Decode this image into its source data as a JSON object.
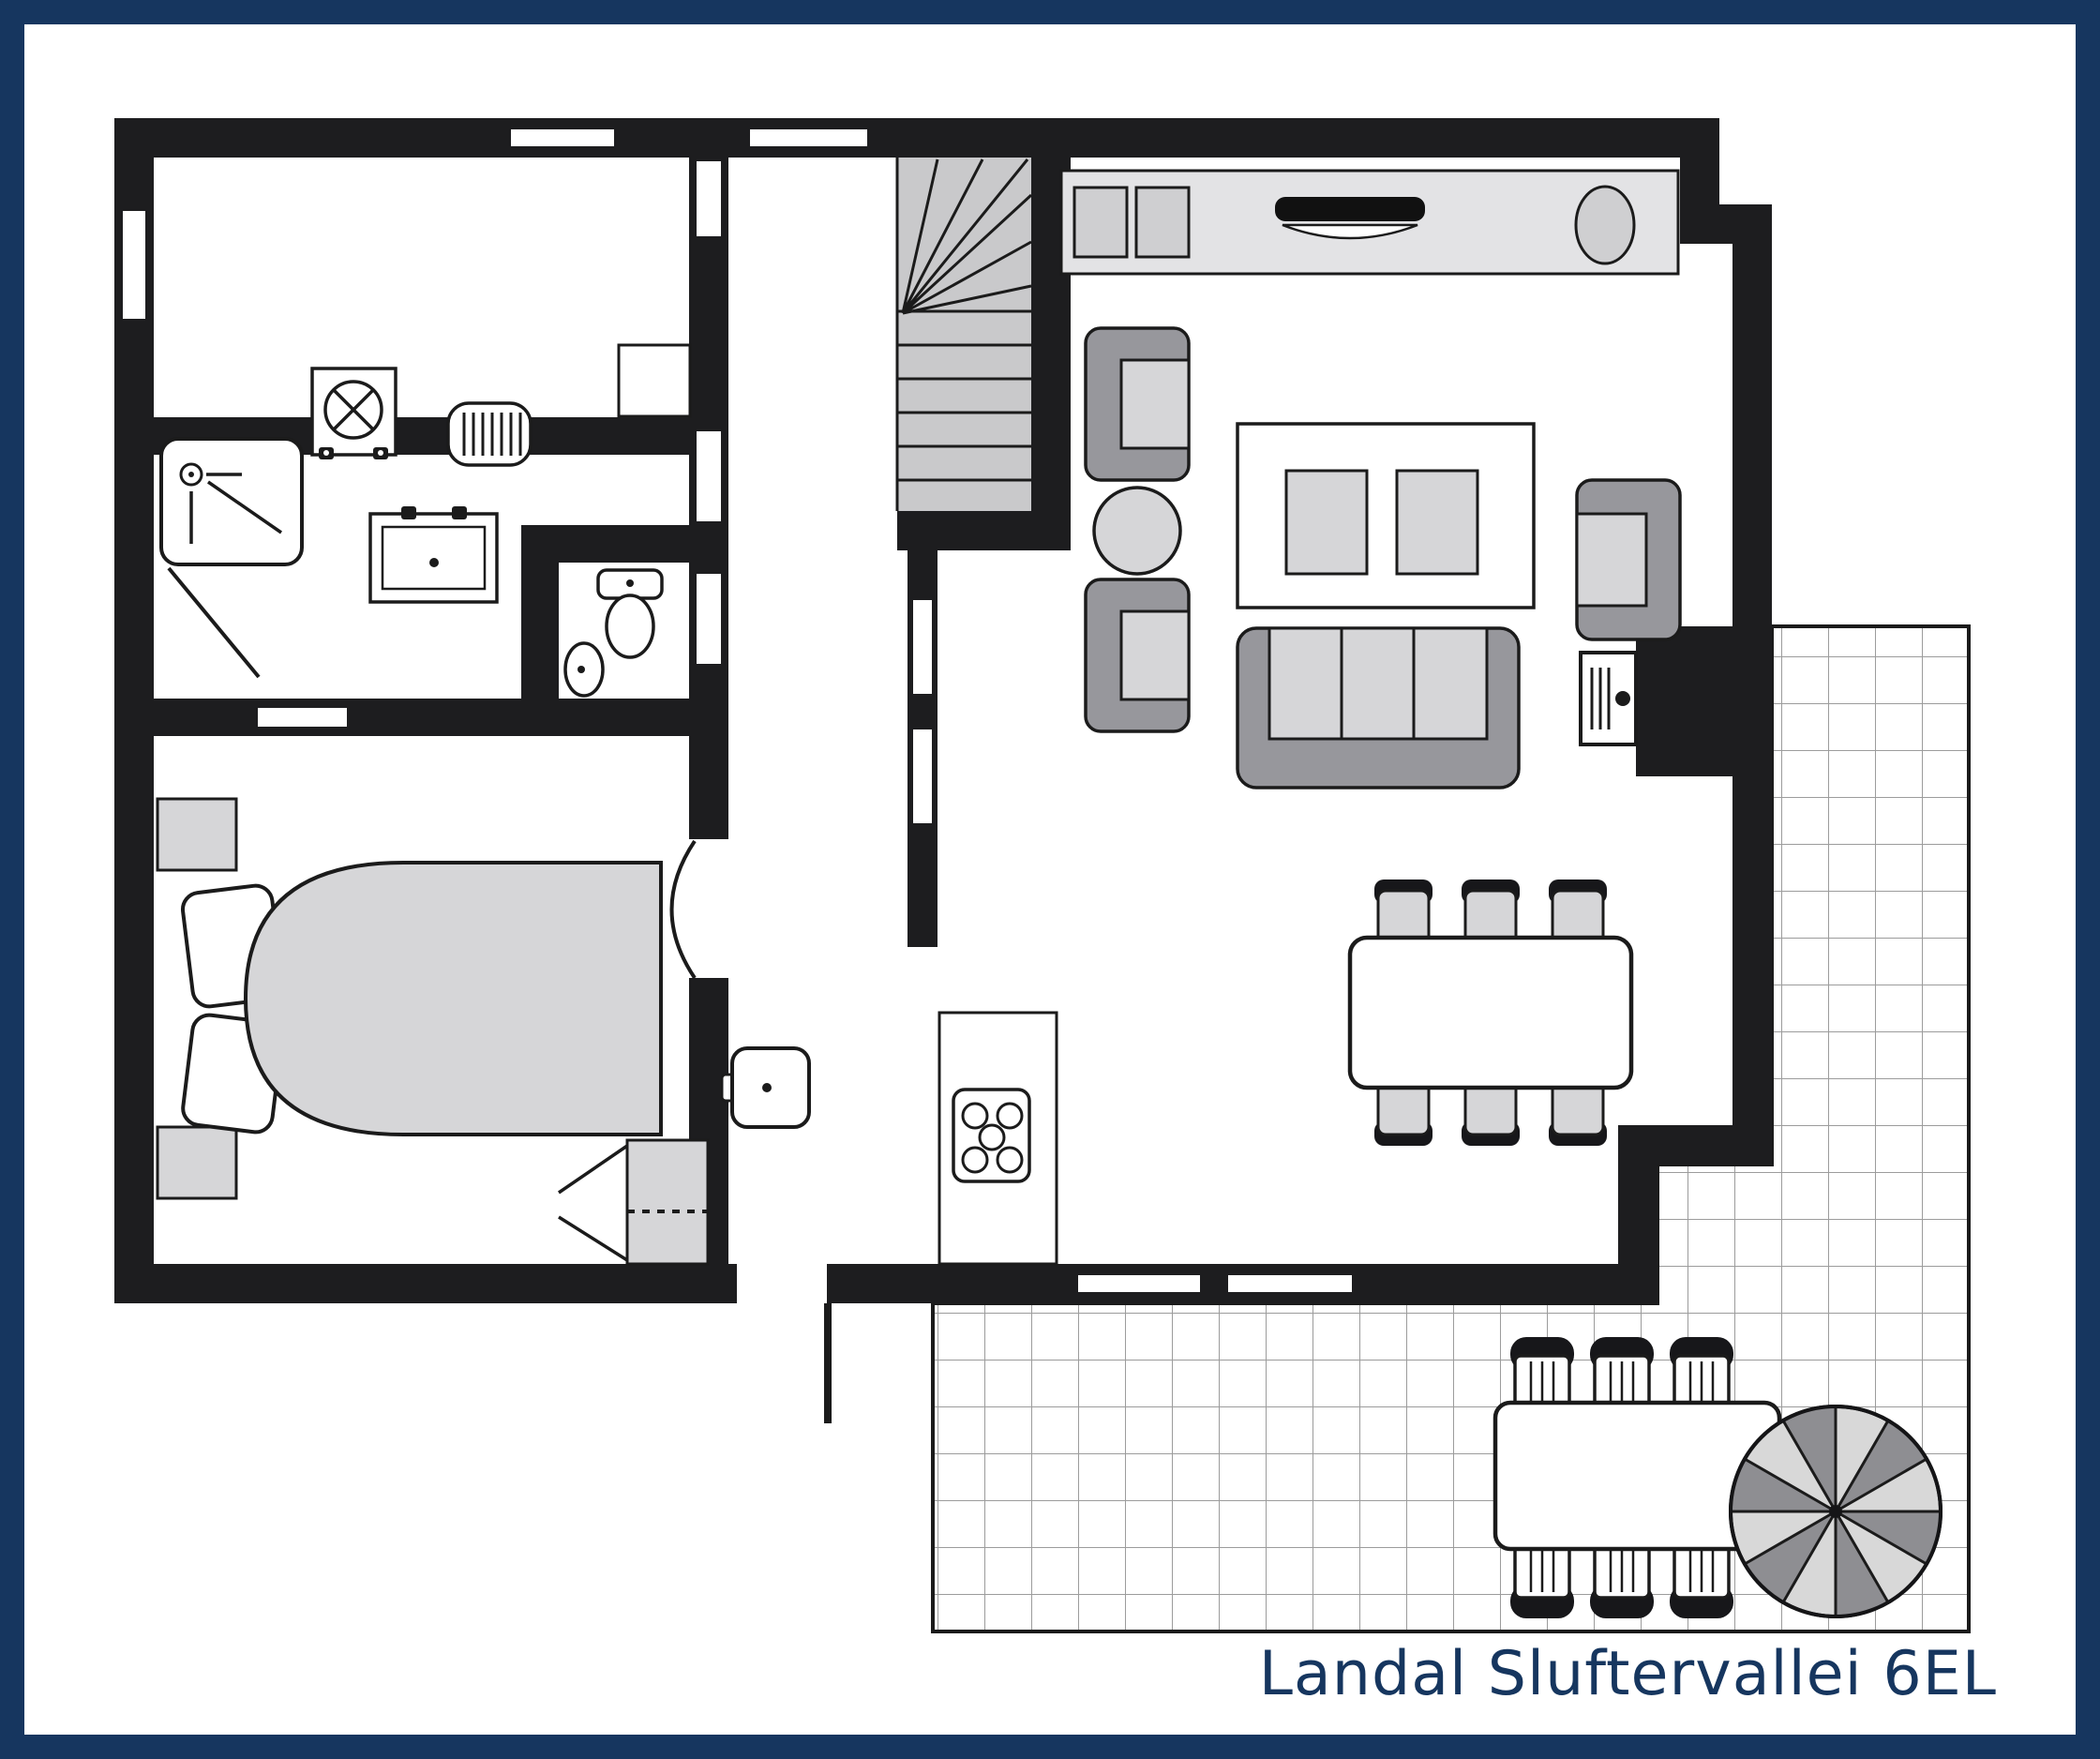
{
  "title": "Landal Sluftervallei 6EL",
  "colors": {
    "frame-navy": "#16365f",
    "wall-black": "#1d1d1f",
    "line": "#1b1b1b",
    "furn-light": "#d6d6d8",
    "furn-mid": "#97979c",
    "counter-gray": "#e3e3e5",
    "stair-gray": "#c9c9cb",
    "grid-gray": "#9c9c9c",
    "paper": "#ffffff"
  },
  "plan": {
    "type": "floor-plan",
    "fixtures": [
      "washing-machine",
      "radiator",
      "storage-cupboard",
      "shower",
      "shower-door",
      "double-washbasin",
      "toilet",
      "corner-basin",
      "winder-staircase",
      "hall-washbasin",
      "kitchen-counter",
      "hob-2-plate",
      "kitchen-sink",
      "round-basin",
      "kitchen-island",
      "hob-5-burner",
      "armchair",
      "armchair",
      "armchair",
      "round-side-table",
      "coffee-table",
      "sofa-3-seat",
      "wood-stove",
      "chimney-block",
      "dining-table",
      "dining-chair",
      "dining-chair",
      "dining-chair",
      "dining-chair",
      "dining-chair",
      "dining-chair",
      "double-bed",
      "pillow",
      "pillow",
      "nightstand",
      "nightstand",
      "wardrobe",
      "bedroom-door-arc",
      "front-door-leaf",
      "terrace-tiles",
      "outdoor-table",
      "outdoor-chair",
      "outdoor-chair",
      "outdoor-chair",
      "outdoor-chair",
      "outdoor-chair",
      "outdoor-chair",
      "parasol"
    ]
  }
}
